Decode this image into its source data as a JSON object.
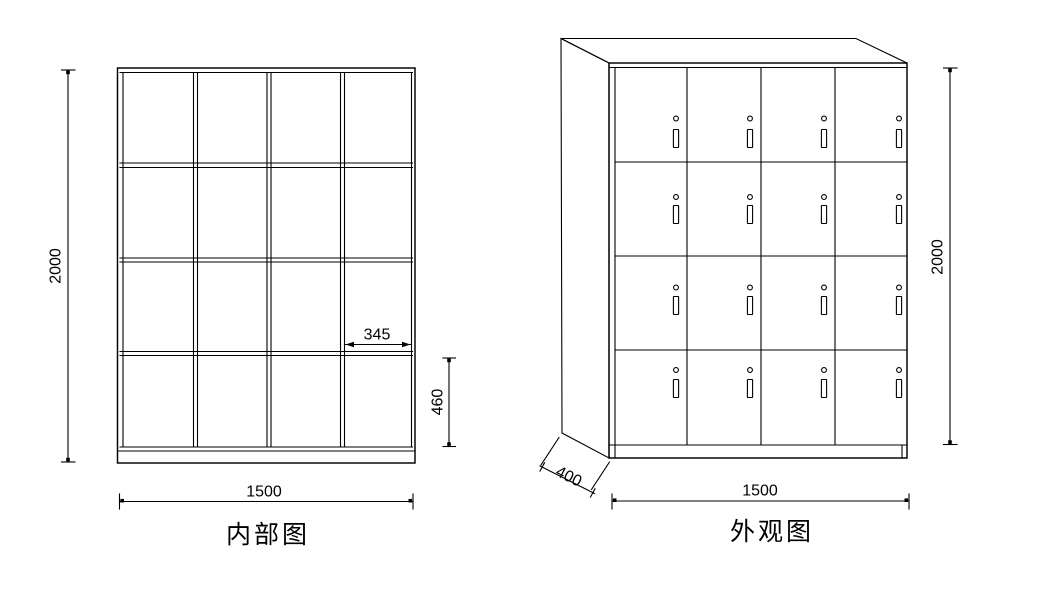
{
  "drawing": {
    "background_color": "#ffffff",
    "line_color": "#000000",
    "views": {
      "internal": {
        "title": "内部图",
        "grid_rows": 4,
        "grid_columns": 4,
        "compartments": 16,
        "dim_height": "2000",
        "dim_width": "1500",
        "dim_cell_width": "345",
        "dim_cell_height": "460"
      },
      "external": {
        "title": "外观图",
        "door_rows": 4,
        "door_columns": 4,
        "doors": 16,
        "lock_icons": [
          "keyhole-icon",
          "handle-icon"
        ],
        "dim_height": "2000",
        "dim_width": "1500",
        "dim_depth": "400"
      }
    }
  }
}
